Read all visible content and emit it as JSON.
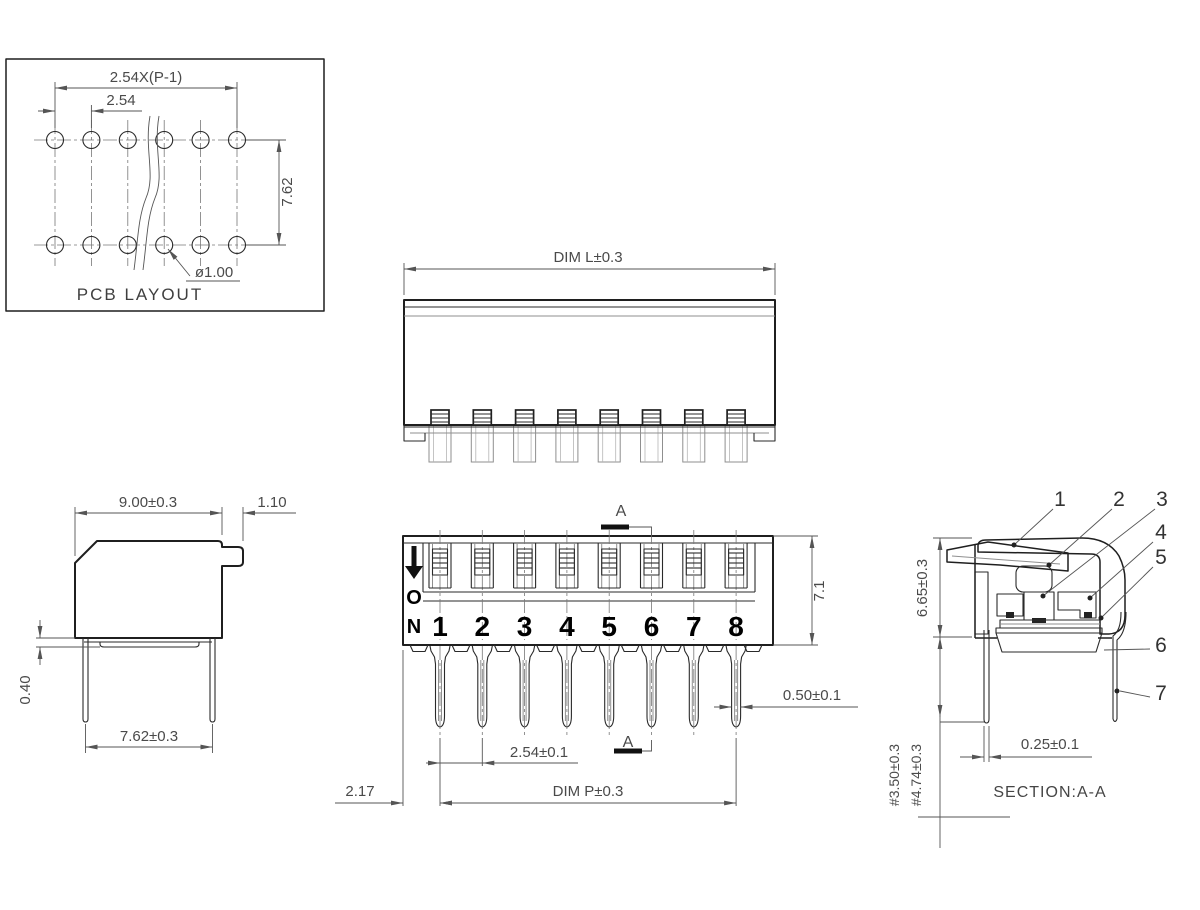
{
  "meta": {
    "background": "#ffffff",
    "line_color": "#1f1f1f",
    "dim_color": "#4a4a4a"
  },
  "views": {
    "pcb_layout": {
      "title": "PCB LAYOUT",
      "dim_pitch_total": "2.54X(P-1)",
      "dim_pitch": "2.54",
      "dim_row_spacing": "7.62",
      "dim_hole_diameter": "ø1.00"
    },
    "top_view": {
      "dim_length": "DIM L±0.3"
    },
    "side_view": {
      "dim_body_width": "9.00±0.3",
      "dim_tab": "1.10",
      "dim_standoff": "0.40",
      "dim_pin_row_spacing": "7.62±0.3"
    },
    "front_view": {
      "on_letter_o": "O",
      "on_letter_n": "N",
      "switch_numbers": [
        "1",
        "2",
        "3",
        "4",
        "5",
        "6",
        "7",
        "8"
      ],
      "section_marker": "A",
      "dim_height": "7.1",
      "dim_pin_width": "0.50±0.1",
      "dim_pin_pitch": "2.54±0.1",
      "dim_end_offset": "2.17",
      "dim_pin_span": "DIM P±0.3"
    },
    "section_view": {
      "title": "SECTION:A-A",
      "part_numbers": [
        "1",
        "2",
        "3",
        "4",
        "5",
        "6",
        "7"
      ],
      "dim_body_height": "6.65±0.3",
      "dim_pin_length_a": "#3.50±0.3",
      "dim_pin_length_b": "#4.74±0.3",
      "dim_pin_thickness": "0.25±0.1"
    }
  }
}
